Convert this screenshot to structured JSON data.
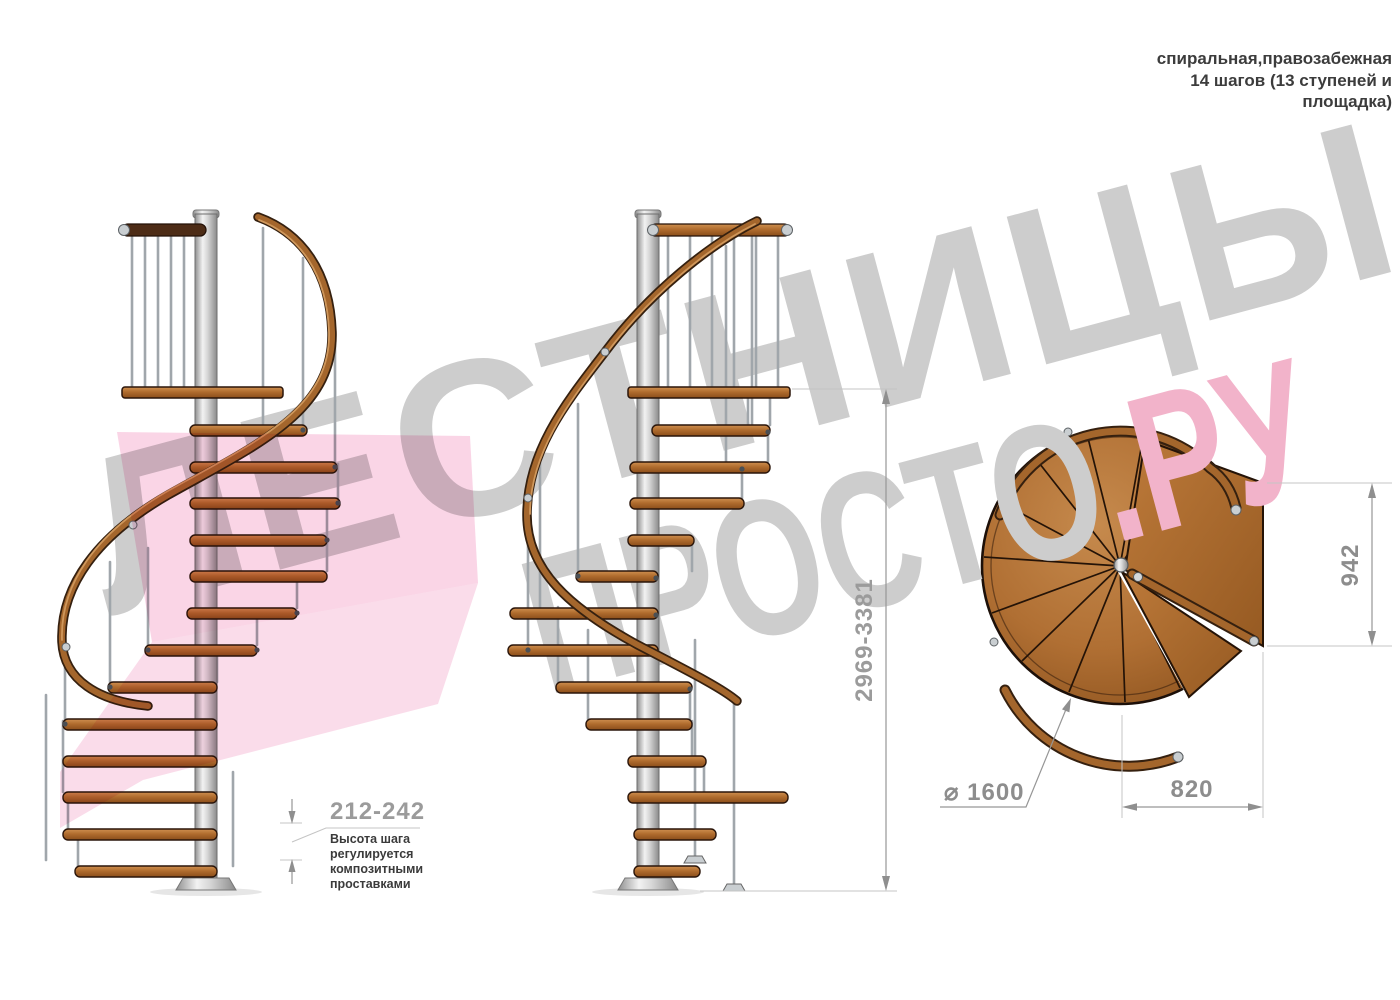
{
  "header": {
    "line1": "спиральная,правозабежная",
    "line2": "14 шагов (13 ступеней и",
    "line3": "площадка)"
  },
  "watermark": {
    "word1": "ЛЕСТНИЦЫ",
    "word2": "ПРОСТО",
    "suffix": ".РУ"
  },
  "dimensions": {
    "step_height": "212-242",
    "step_height_note": [
      "Высота шага",
      "регулируется",
      "композитными",
      "проставками"
    ],
    "total_height": "2969-3381",
    "platform_depth": "942",
    "diameter": "⌀ 1600",
    "landing_width": "820"
  },
  "colors": {
    "wood": "#b06f33",
    "metal_pole": "#d9d9d9",
    "dimension_text_gray": "#9b9b9b",
    "note_text": "#3b3b3b",
    "watermark_gray": "#cdcdcd",
    "watermark_pink": "#f2b3ca",
    "ribbon_pink": "#f191bd"
  }
}
